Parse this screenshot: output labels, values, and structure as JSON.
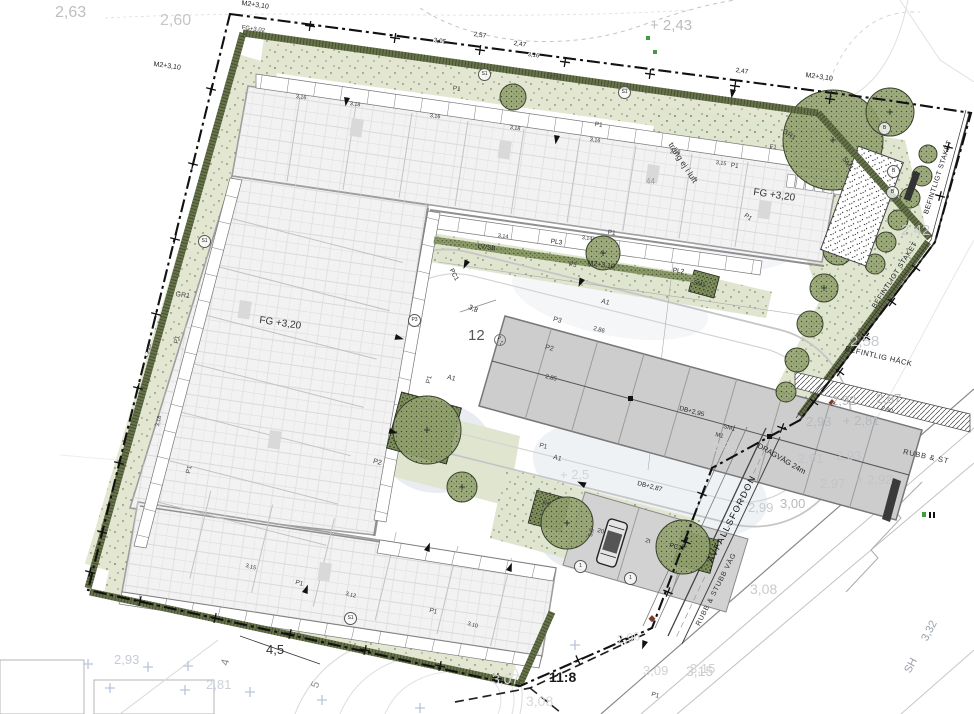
{
  "drawing_title": "Situationsplan",
  "parcel_label": "11:8",
  "colors": {
    "boundary": "#111111",
    "hedge": "#66734a",
    "planting": "#e3e7d2",
    "tree_canopy": "#93a36f",
    "building_fill": "#f2f2f2",
    "building_line": "#9e9e9e",
    "carport_fill": "#cdcdcd",
    "water_wash": "#cdd5e0",
    "faint_text": "#c6c9cb",
    "survey_cross_blue": "#b9c3de",
    "marker_green": "#3f9d3f",
    "marker_red": "#7a3b2e"
  },
  "labels": [
    {
      "t": "2,63",
      "x": 55,
      "y": 5,
      "s": 16,
      "c": "#bcbfc1"
    },
    {
      "t": "2,60",
      "x": 160,
      "y": 13,
      "s": 16,
      "c": "#c3c6c8"
    },
    {
      "t": "+ 2,43",
      "x": 650,
      "y": 18,
      "s": 15,
      "c": "#b9beb9"
    },
    {
      "t": "2,42",
      "x": 901,
      "y": 223,
      "s": 15,
      "c": "#c8cbcd"
    },
    {
      "t": "2,58",
      "x": 850,
      "y": 334,
      "s": 15,
      "c": "#c8cbcd"
    },
    {
      "t": "2,92",
      "x": 831,
      "y": 394,
      "s": 13,
      "c": "#b6babe"
    },
    {
      "t": "2,87",
      "x": 876,
      "y": 392,
      "s": 13,
      "c": "#b6babe"
    },
    {
      "t": "2,93",
      "x": 806,
      "y": 415,
      "s": 13,
      "c": "#b6babe"
    },
    {
      "t": "+ 2,81",
      "x": 843,
      "y": 414,
      "s": 13,
      "c": "#b6babe"
    },
    {
      "t": "2,91",
      "x": 798,
      "y": 452,
      "s": 13,
      "c": "#c1c4c8"
    },
    {
      "t": "2,93",
      "x": 836,
      "y": 449,
      "s": 13,
      "c": "#c1c4c8"
    },
    {
      "t": "2,97",
      "x": 820,
      "y": 477,
      "s": 13,
      "c": "#c1c4c8"
    },
    {
      "t": "+ 2,92",
      "x": 856,
      "y": 473,
      "s": 13,
      "c": "#c1c4c8"
    },
    {
      "t": "2,99",
      "x": 748,
      "y": 501,
      "s": 13,
      "c": "#c8cbcd"
    },
    {
      "t": "3,00",
      "x": 780,
      "y": 497,
      "s": 13,
      "c": "#b6babe"
    },
    {
      "t": "2,95",
      "x": 712,
      "y": 440,
      "s": 13,
      "c": "#cfd2d4"
    },
    {
      "t": "3,08",
      "x": 750,
      "y": 582,
      "s": 14,
      "c": "#c8cbcd"
    },
    {
      "t": "3,15",
      "x": 686,
      "y": 664,
      "s": 14,
      "c": "#c8cbcd"
    },
    {
      "t": "3,07",
      "x": 492,
      "y": 672,
      "s": 14,
      "c": "#d6d8da"
    },
    {
      "t": "3,08",
      "x": 526,
      "y": 694,
      "s": 14,
      "c": "#d6d8da"
    },
    {
      "t": "11:8",
      "x": 549,
      "y": 670,
      "s": 14,
      "c": "#1a1a1a",
      "b": 1
    },
    {
      "t": "2,96",
      "x": 616,
      "y": 634,
      "s": 12,
      "c": "#d6d8da",
      "r": -10
    },
    {
      "t": "3,09",
      "x": 643,
      "y": 664,
      "s": 13,
      "c": "#cfd2d4"
    },
    {
      "t": "3,15",
      "x": 690,
      "y": 662,
      "s": 13,
      "c": "#cfd2d4"
    },
    {
      "t": "2,93",
      "x": 114,
      "y": 653,
      "s": 13,
      "c": "#c5cbd8"
    },
    {
      "t": "2,81",
      "x": 206,
      "y": 678,
      "s": 13,
      "c": "#cbd0db"
    },
    {
      "t": "+ 2,5",
      "x": 560,
      "y": 468,
      "s": 13,
      "c": "#d2d5d7"
    },
    {
      "t": "4,5",
      "x": 266,
      "y": 643,
      "s": 13,
      "c": "#333"
    },
    {
      "t": "4",
      "x": 220,
      "y": 664,
      "s": 11,
      "c": "#888",
      "r": -75
    },
    {
      "t": "5",
      "x": 310,
      "y": 686,
      "s": 11,
      "c": "#888",
      "r": -70
    },
    {
      "t": "FG +3,20",
      "x": 260,
      "y": 316,
      "s": 10,
      "c": "#333",
      "r": 8
    },
    {
      "t": "FG +3,20",
      "x": 754,
      "y": 188,
      "s": 10,
      "c": "#333",
      "r": 8
    },
    {
      "t": "FG+3,02",
      "x": 242,
      "y": 25,
      "s": 6,
      "c": "#333",
      "r": 8
    },
    {
      "t": "M2+3,10",
      "x": 242,
      "y": 0,
      "s": 7,
      "r": 8
    },
    {
      "t": "M2+3,10",
      "x": 154,
      "y": 61,
      "s": 7,
      "r": 8
    },
    {
      "t": "M2+3,10",
      "x": 806,
      "y": 72,
      "s": 7,
      "r": 8
    },
    {
      "t": "M2+3,10",
      "x": 588,
      "y": 260,
      "s": 7,
      "r": 8
    },
    {
      "t": "12",
      "x": 468,
      "y": 328,
      "s": 15,
      "c": "#555"
    },
    {
      "t": "DB+2,95",
      "x": 680,
      "y": 406,
      "s": 6.5,
      "r": 15
    },
    {
      "t": "DB+2,87",
      "x": 638,
      "y": 481,
      "s": 6.5,
      "r": 15
    },
    {
      "t": "LV/SB",
      "x": 478,
      "y": 244,
      "s": 6.5,
      "r": 8
    },
    {
      "t": "PC1",
      "x": 453,
      "y": 268,
      "s": 6.5,
      "r": 62
    },
    {
      "t": "PC1",
      "x": 670,
      "y": 543,
      "s": 6.5,
      "r": 15
    },
    {
      "t": "PL3",
      "x": 551,
      "y": 239,
      "s": 6.5,
      "r": 8
    },
    {
      "t": "PL2",
      "x": 673,
      "y": 268,
      "s": 6.5,
      "r": 8
    },
    {
      "t": "GR1",
      "x": 548,
      "y": 72,
      "s": 7,
      "c": "#444",
      "r": 8
    },
    {
      "t": "GR1",
      "x": 176,
      "y": 291,
      "s": 7,
      "c": "#444",
      "r": 8
    },
    {
      "t": "GR1",
      "x": 785,
      "y": 128,
      "s": 7,
      "c": "#444",
      "r": 35
    },
    {
      "t": "SM1",
      "x": 846,
      "y": 156,
      "s": 7,
      "c": "#333",
      "r": 55
    },
    {
      "t": "SM1",
      "x": 694,
      "y": 280,
      "s": 6,
      "c": "#333",
      "r": 15
    },
    {
      "t": "SM1",
      "x": 724,
      "y": 424,
      "s": 6,
      "c": "#333",
      "r": 15
    },
    {
      "t": "M1",
      "x": 716,
      "y": 432,
      "s": 6,
      "c": "#333",
      "r": 15
    },
    {
      "t": "A1",
      "x": 602,
      "y": 298,
      "s": 7,
      "c": "#444",
      "r": 15
    },
    {
      "t": "A1",
      "x": 448,
      "y": 374,
      "s": 7,
      "c": "#444",
      "r": 15
    },
    {
      "t": "A1",
      "x": 554,
      "y": 454,
      "s": 7,
      "c": "#444",
      "r": 15
    },
    {
      "t": "P2",
      "x": 546,
      "y": 344,
      "s": 7,
      "c": "#444",
      "r": 15
    },
    {
      "t": "P2",
      "x": 374,
      "y": 458,
      "s": 7,
      "c": "#444",
      "r": 15
    },
    {
      "t": "P2",
      "x": 543,
      "y": 500,
      "s": 7,
      "c": "#444",
      "r": 15
    },
    {
      "t": "P3",
      "x": 554,
      "y": 316,
      "s": 7,
      "c": "#444",
      "r": 15
    },
    {
      "t": "P3",
      "x": 569,
      "y": 262,
      "s": 6.5,
      "c": "#444",
      "r": 8
    },
    {
      "t": "P1",
      "x": 453,
      "y": 86,
      "s": 6.5,
      "c": "#444",
      "r": 8
    },
    {
      "t": "P1",
      "x": 595,
      "y": 122,
      "s": 6.5,
      "c": "#444",
      "r": 8
    },
    {
      "t": "P1",
      "x": 731,
      "y": 163,
      "s": 6.5,
      "c": "#444",
      "r": 8
    },
    {
      "t": "P1",
      "x": 174,
      "y": 343,
      "s": 6.5,
      "c": "#444",
      "r": -78
    },
    {
      "t": "P1",
      "x": 186,
      "y": 473,
      "s": 6.5,
      "c": "#444",
      "r": -78
    },
    {
      "t": "P1",
      "x": 296,
      "y": 580,
      "s": 6.5,
      "c": "#444",
      "r": 15
    },
    {
      "t": "P1",
      "x": 430,
      "y": 608,
      "s": 6.5,
      "c": "#444",
      "r": 15
    },
    {
      "t": "P1",
      "x": 426,
      "y": 383,
      "s": 6.5,
      "c": "#444",
      "r": -78
    },
    {
      "t": "P1",
      "x": 540,
      "y": 443,
      "s": 6.5,
      "c": "#444",
      "r": 15
    },
    {
      "t": "P1",
      "x": 608,
      "y": 230,
      "s": 6.5,
      "c": "#444",
      "r": 8
    },
    {
      "t": "P1",
      "x": 746,
      "y": 213,
      "s": 6.5,
      "c": "#444",
      "r": 35
    },
    {
      "t": "P1",
      "x": 652,
      "y": 692,
      "s": 6.5,
      "c": "#444",
      "r": 15
    },
    {
      "t": "F1",
      "x": 770,
      "y": 144,
      "s": 6,
      "c": "#444",
      "r": 8
    },
    {
      "t": "träng ej i luft",
      "x": 674,
      "y": 141,
      "s": 8.5,
      "c": "#333",
      "r": 57
    },
    {
      "t": "44",
      "x": 646,
      "y": 178,
      "s": 8,
      "c": "#999"
    },
    {
      "t": "BEFINTLIG HÄCK",
      "x": 846,
      "y": 345,
      "s": 7.5,
      "r": 13,
      "sp": 0.5
    },
    {
      "t": "BEFINTLIGT STAKET",
      "x": 923,
      "y": 213,
      "s": 7,
      "r": -72,
      "sp": 0.5
    },
    {
      "t": "BEFINTLIGT STAKET",
      "x": 871,
      "y": 306,
      "s": 7,
      "r": -57,
      "sp": 0.5
    },
    {
      "t": "AVFALLSFORDON",
      "x": 706,
      "y": 560,
      "s": 9,
      "c": "#111",
      "r": -63,
      "sp": 1.5
    },
    {
      "t": "RUBB & STUBB VÄG",
      "x": 695,
      "y": 624,
      "s": 7,
      "c": "#333",
      "r": -63,
      "sp": 0.8
    },
    {
      "t": "RUBB & ST",
      "x": 904,
      "y": 448,
      "s": 7.5,
      "c": "#333",
      "r": 12,
      "sp": 0.8
    },
    {
      "t": "DRAGVÄG 24m",
      "x": 760,
      "y": 442,
      "s": 7.5,
      "r": 30
    },
    {
      "t": "SH",
      "x": 903,
      "y": 670,
      "s": 11,
      "c": "#99a0aa",
      "r": -62
    },
    {
      "t": "3,32",
      "x": 920,
      "y": 638,
      "s": 11,
      "c": "#99a0aa",
      "r": -62
    },
    {
      "t": "2,47",
      "x": 736,
      "y": 68,
      "s": 6.5,
      "r": 8
    },
    {
      "t": "2,47",
      "x": 514,
      "y": 41,
      "s": 6.5,
      "r": 8
    },
    {
      "t": "2,57",
      "x": 474,
      "y": 32,
      "s": 6.5,
      "r": 8
    },
    {
      "t": "3,05",
      "x": 434,
      "y": 38,
      "s": 6.5,
      "r": 8
    },
    {
      "t": "3,16",
      "x": 528,
      "y": 52,
      "s": 6,
      "r": 8
    },
    {
      "t": "3,8",
      "x": 470,
      "y": 304,
      "s": 7,
      "r": 25
    },
    {
      "t": "3,16",
      "x": 296,
      "y": 95,
      "s": 5.5,
      "r": 8,
      "c": "#333"
    },
    {
      "t": "3,18",
      "x": 350,
      "y": 102,
      "s": 5.5,
      "r": 8,
      "c": "#333"
    },
    {
      "t": "3,16",
      "x": 430,
      "y": 114,
      "s": 5.5,
      "r": 8,
      "c": "#333"
    },
    {
      "t": "3,18",
      "x": 510,
      "y": 126,
      "s": 5.5,
      "r": 8,
      "c": "#333"
    },
    {
      "t": "3,16",
      "x": 590,
      "y": 138,
      "s": 5.5,
      "r": 8,
      "c": "#333"
    },
    {
      "t": "3,18",
      "x": 670,
      "y": 150,
      "s": 5.5,
      "r": 8,
      "c": "#333"
    },
    {
      "t": "3,15",
      "x": 716,
      "y": 161,
      "s": 5.5,
      "r": 8,
      "c": "#333"
    },
    {
      "t": "3,19",
      "x": 146,
      "y": 354,
      "s": 5.5,
      "r": -78,
      "c": "#333"
    },
    {
      "t": "3,18",
      "x": 156,
      "y": 426,
      "s": 5.5,
      "r": -78,
      "c": "#333"
    },
    {
      "t": "3,15",
      "x": 246,
      "y": 564,
      "s": 5.5,
      "r": 15,
      "c": "#333"
    },
    {
      "t": "3,12",
      "x": 346,
      "y": 592,
      "s": 5.5,
      "r": 15,
      "c": "#333"
    },
    {
      "t": "3,10",
      "x": 468,
      "y": 622,
      "s": 5.5,
      "r": 15,
      "c": "#333"
    },
    {
      "t": "3,14",
      "x": 498,
      "y": 234,
      "s": 5.5,
      "r": 8,
      "c": "#333"
    },
    {
      "t": "3,14",
      "x": 582,
      "y": 236,
      "s": 5.5,
      "r": 8,
      "c": "#333"
    },
    {
      "t": "2,86",
      "x": 594,
      "y": 326,
      "s": 6,
      "r": 15,
      "c": "#333"
    },
    {
      "t": "2,90",
      "x": 882,
      "y": 406,
      "s": 6,
      "r": 15,
      "c": "#333"
    },
    {
      "t": "2,85",
      "x": 546,
      "y": 374,
      "s": 6,
      "r": 15,
      "c": "#333"
    },
    {
      "t": "20",
      "x": 598,
      "y": 528,
      "s": 6,
      "r": 15,
      "c": "#333"
    },
    {
      "t": "2t",
      "x": 646,
      "y": 538,
      "s": 6,
      "r": 15,
      "c": "#333"
    },
    {
      "t": "5,0",
      "x": 588,
      "y": 536,
      "s": 6,
      "r": -75,
      "c": "#333"
    },
    {
      "t": "S1",
      "x": 198,
      "y": 235,
      "circ": 1
    },
    {
      "t": "S1",
      "x": 478,
      "y": 68,
      "circ": 1
    },
    {
      "t": "S1",
      "x": 618,
      "y": 86,
      "circ": 1
    },
    {
      "t": "S1",
      "x": 344,
      "y": 612,
      "circ": 1
    },
    {
      "t": "B",
      "x": 878,
      "y": 122,
      "circ": 1
    },
    {
      "t": "B",
      "x": 887,
      "y": 165,
      "circ": 1
    },
    {
      "t": "B",
      "x": 886,
      "y": 186,
      "circ": 1
    },
    {
      "t": "P3",
      "x": 408,
      "y": 314,
      "circ": 1
    },
    {
      "t": "1",
      "x": 574,
      "y": 560,
      "circ": 1
    },
    {
      "t": "1",
      "x": 624,
      "y": 572,
      "circ": 1
    }
  ]
}
